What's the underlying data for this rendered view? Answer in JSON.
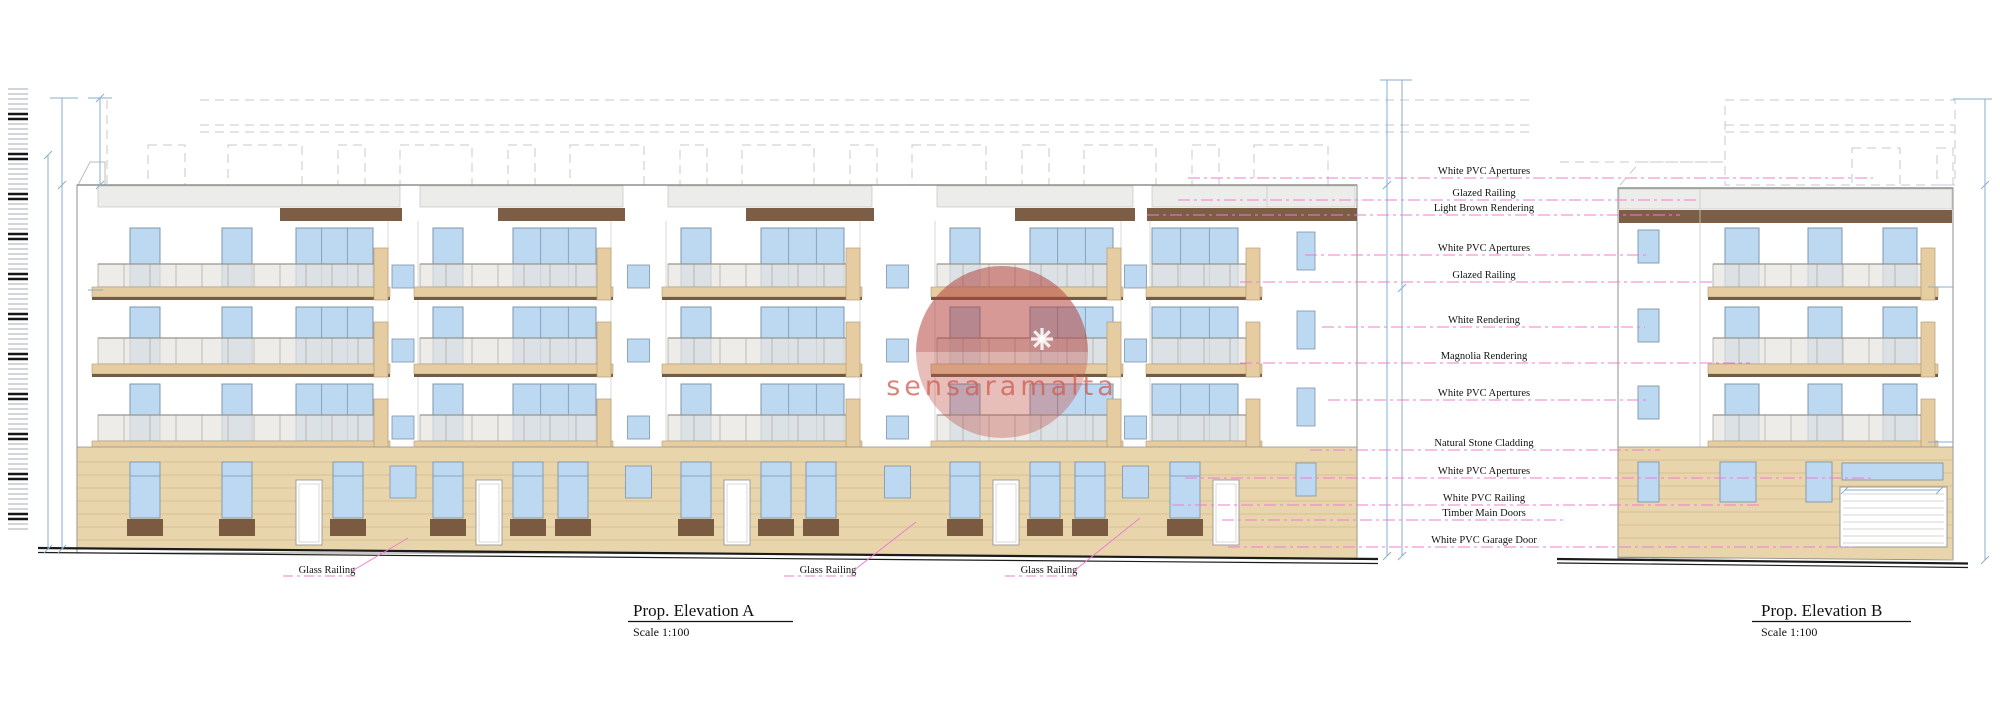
{
  "drawing_type": "architectural-elevation",
  "titles": {
    "a": {
      "label": "Prop. Elevation A",
      "scale": "Scale 1:100"
    },
    "b": {
      "label": "Prop. Elevation B",
      "scale": "Scale 1:100"
    }
  },
  "watermark": {
    "text": "sensaramalta"
  },
  "annotations": [
    {
      "label": "White PVC Apertures",
      "y": 178,
      "x1": 1188,
      "x2": 1873
    },
    {
      "label": "Glazed Railing",
      "y": 200,
      "x1": 1178,
      "x2": 1700
    },
    {
      "label": "Light Brown Rendering",
      "y": 215,
      "x1": 1147,
      "x2": 1680
    },
    {
      "label": "White PVC Apertures",
      "y": 255,
      "x1": 1305,
      "x2": 1650
    },
    {
      "label": "Glazed Railing",
      "y": 282,
      "x1": 1240,
      "x2": 1713
    },
    {
      "label": "White Rendering",
      "y": 327,
      "x1": 1322,
      "x2": 1645
    },
    {
      "label": "Magnolia Rendering",
      "y": 363,
      "x1": 1240,
      "x2": 1750
    },
    {
      "label": "White PVC Apertures",
      "y": 400,
      "x1": 1328,
      "x2": 1648
    },
    {
      "label": "Natural Stone Cladding",
      "y": 450,
      "x1": 1310,
      "x2": 1660
    },
    {
      "label": "White PVC Apertures",
      "y": 478,
      "x1": 1185,
      "x2": 1873
    },
    {
      "label": "White PVC Railing",
      "y": 505,
      "x1": 1172,
      "x2": 1762
    },
    {
      "label": "Timber Main Doors",
      "y": 520,
      "x1": 1222,
      "x2": 1565
    },
    {
      "label": "White PVC Garage Door",
      "y": 547,
      "x1": 1228,
      "x2": 1852
    }
  ],
  "glass_railing_labels": [
    {
      "label": "Glass Railing",
      "cx": 327,
      "y": 573,
      "leader": [
        352,
        571,
        408,
        538
      ]
    },
    {
      "label": "Glass Railing",
      "cx": 828,
      "y": 573,
      "leader": [
        853,
        571,
        916,
        522
      ]
    },
    {
      "label": "Glass Railing",
      "cx": 1049,
      "y": 573,
      "leader": [
        1074,
        571,
        1140,
        518
      ]
    }
  ],
  "colors": {
    "window_fill": "#bdd8f1",
    "window_border": "#7e95ab",
    "tan": "#e6cda1",
    "tan_border": "#b49b74",
    "tan_dark": "#6f5b47",
    "stone": "#e9d5ab",
    "stone_line": "#c6ae81",
    "rail_fill": "rgba(231,229,224,0.72)",
    "rail_line": "#a9a79f",
    "brown_band": "#7b5e45",
    "brown_base": "#7a5b42",
    "parapet": "#ececea",
    "outline": "#8f8f8b",
    "wall_line": "#c9c9c5",
    "pink": "#ef7cd2",
    "blue_dim": "#86aed1",
    "dash_gray": "#c6cacf",
    "street": "#1c1c1c",
    "hatch_gray": "#b6bcc2",
    "hatch_black": "#161616",
    "watermark_red": "rgba(195,85,75,0.38)",
    "watermark_dark": "rgba(160,45,40,0.25)",
    "label_x_center": 1484
  },
  "geometry": {
    "canvas": {
      "w": 2000,
      "h": 722
    },
    "floors": [
      {
        "winTop": 228,
        "winBot": 287,
        "railTop": 264,
        "slabTop": 287,
        "slabBot": 297
      },
      {
        "winTop": 307,
        "winBot": 364,
        "railTop": 338,
        "slabTop": 364,
        "slabBot": 374
      },
      {
        "winTop": 384,
        "winBot": 441,
        "railTop": 415,
        "slabTop": 441,
        "slabBot": 451
      }
    ],
    "buildingA": {
      "left": 77,
      "right": 1357,
      "top": 185,
      "parapetBot": 207,
      "brownTop": 208,
      "brownH": 13,
      "stoneTop": 447,
      "bottomLeftY": 549,
      "bottomRightY": 559,
      "bays": [
        {
          "x": 96,
          "w": 292,
          "narrow": [
            34,
            126
          ],
          "wide": [
            200,
            77
          ],
          "brown": [
            184,
            122
          ]
        },
        {
          "x": 418,
          "w": 193,
          "narrow": [
            15
          ],
          "wide": [
            95,
            83
          ],
          "brown": [
            80,
            127
          ]
        },
        {
          "x": 666,
          "w": 194,
          "narrow": [
            15
          ],
          "wide": [
            95,
            83
          ],
          "brown": [
            80,
            128
          ]
        },
        {
          "x": 935,
          "w": 186,
          "narrow": [
            15
          ],
          "wide": [
            95,
            83
          ],
          "brown": [
            80,
            120
          ]
        },
        {
          "x": 1150,
          "w": 110,
          "narrow": [],
          "wide": [
            2,
            86
          ],
          "brown": [
            -3,
            210
          ]
        }
      ],
      "rightSection": {
        "winX": 1297,
        "winW": 18
      },
      "streetLine": [
        38,
        548,
        1378,
        559
      ]
    },
    "buildingB": {
      "left": 1618,
      "right": 1953,
      "top": 188,
      "divider": 1700,
      "brownTop": 210,
      "brownH": 13,
      "stoneTop": 447,
      "smallWinX": 1638,
      "smallWinW": 21,
      "mainWins": [
        1725,
        1808,
        1883
      ],
      "mainWinW": 34,
      "railX1": 1713,
      "railX2": 1928,
      "garage": {
        "x": 1840,
        "w": 107,
        "y": 487,
        "h": 60
      },
      "transom": {
        "x": 1842,
        "w": 101,
        "y": 463,
        "h": 17
      },
      "groundWins": [
        [
          1638,
          21
        ],
        [
          1720,
          36
        ],
        [
          1806,
          26
        ]
      ],
      "streetLine": [
        1557,
        559,
        1968,
        563.5
      ]
    },
    "surveyStrip": {
      "x": 8,
      "w": 20,
      "yTop": 89,
      "yBot": 532,
      "step": 5
    },
    "roofBoxesA": [
      [
        148,
        37
      ],
      [
        228,
        74
      ],
      [
        338,
        27
      ],
      [
        400,
        72
      ],
      [
        508,
        27
      ],
      [
        570,
        74
      ],
      [
        680,
        27
      ],
      [
        742,
        72
      ],
      [
        850,
        27
      ],
      [
        912,
        74
      ],
      [
        1022,
        27
      ],
      [
        1084,
        72
      ],
      [
        1192,
        27
      ],
      [
        1254,
        74
      ]
    ],
    "watermarkGeo": {
      "cx": 1002,
      "cy": 352,
      "r": 86,
      "starX": 1042,
      "starY": 339,
      "textY": 395
    }
  }
}
